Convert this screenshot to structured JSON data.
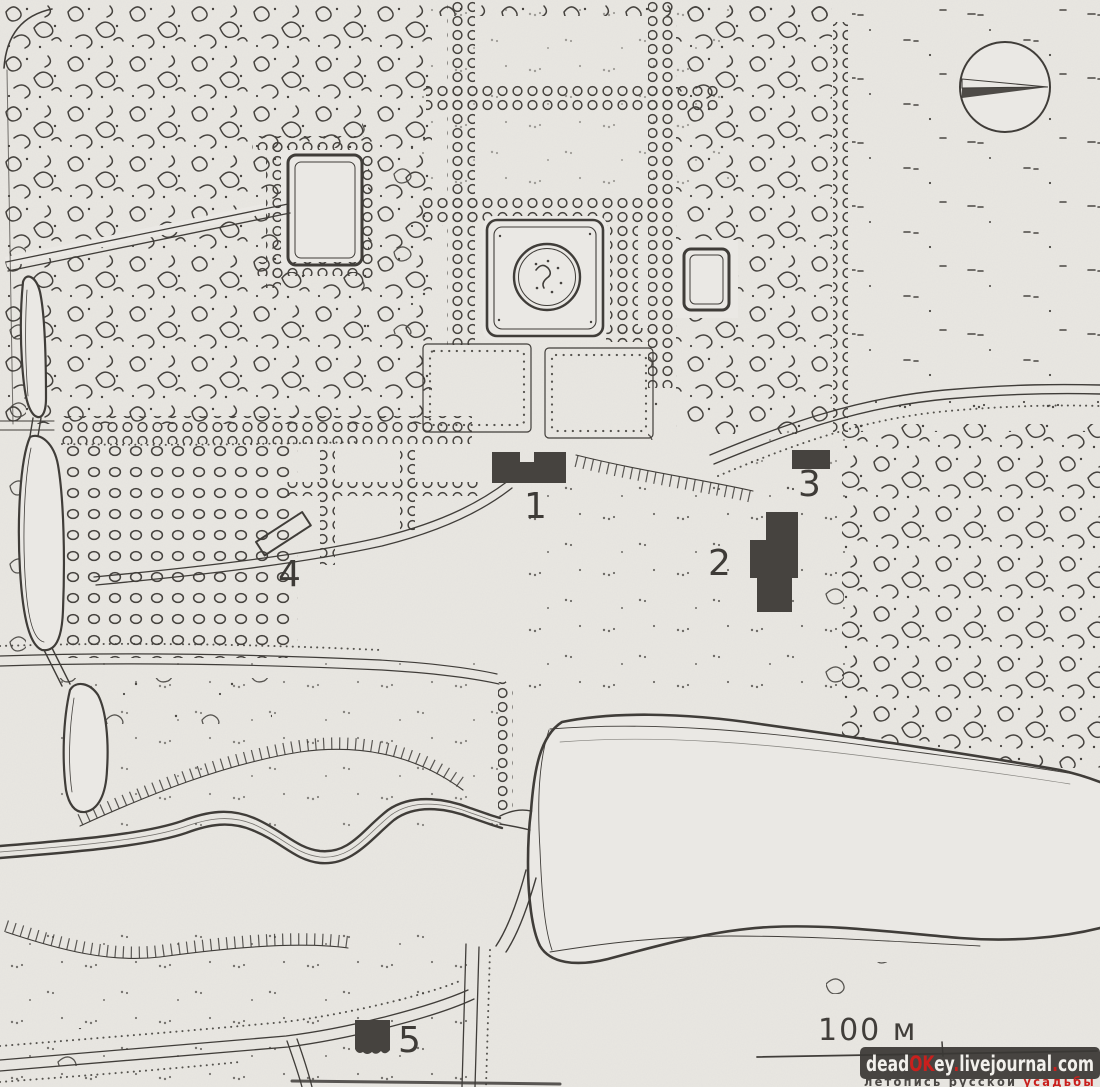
{
  "map": {
    "kind": "scanned hand-drawn estate park plan, black ink on paper",
    "labels": [
      "1",
      "2",
      "3",
      "4",
      "5"
    ],
    "scale": {
      "label": "100 м"
    },
    "compass": "compass-rose-circle-with-needle",
    "colors": {
      "paper": "#e9e7e2",
      "ink": "#403d39",
      "building_fill": "#46433f",
      "accent_red": "#c9201d",
      "watermark_bar": "#3a3835",
      "watermark_text": "#f2f0ec"
    }
  },
  "watermark": {
    "segments": [
      {
        "t": "dead"
      },
      {
        "t": "OK"
      },
      {
        "t": "ey"
      },
      {
        "t": "."
      },
      {
        "t": "livejournal"
      },
      {
        "t": "."
      },
      {
        "t": "com"
      }
    ],
    "tagline": {
      "left": "летопись русской ",
      "right": "усадьбы"
    }
  }
}
